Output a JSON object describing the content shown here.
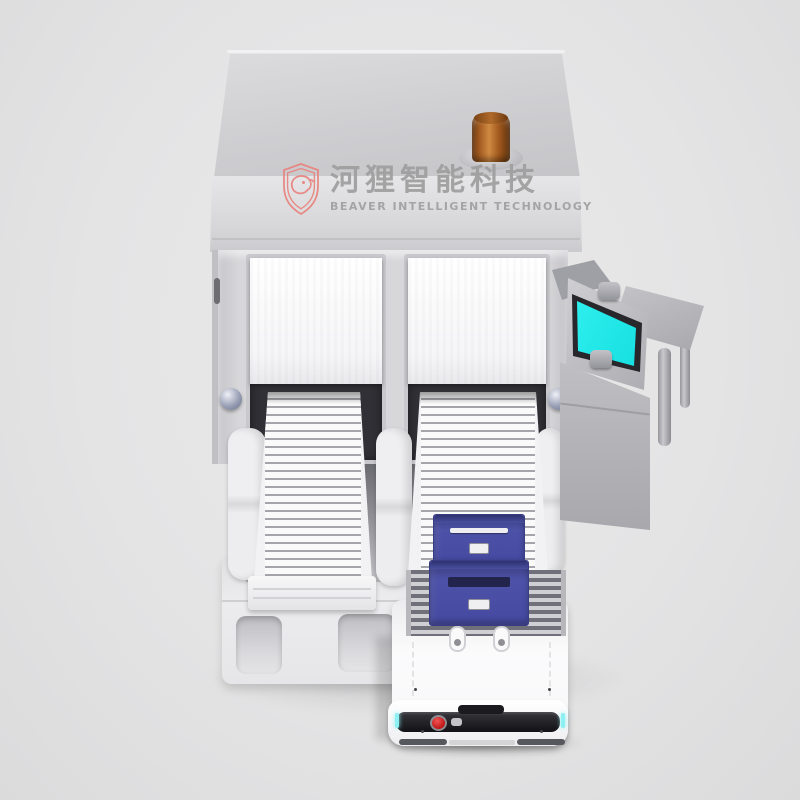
{
  "meta": {
    "kind": "product-render",
    "canvas": {
      "width": 800,
      "height": 800
    },
    "background_color": "#e4e4e4"
  },
  "watermark": {
    "brand_cn": "河狸智能科技",
    "brand_en": "BEAVER INTELLIGENT TECHNOLOGY",
    "icon": "beaver-shield-icon",
    "accent_color": "#e8837e",
    "text_color": "#9e9e9e"
  },
  "scene": {
    "description": "3D render of an automated tote-handling workstation: gray cabinet with amber beacon, two white roller-shutter ports feeding sloped roller conveyors, side touchscreen console with table, two blue totes on the right conveyor, and a white AGV robot docked at a floor platform",
    "cabinet": {
      "name": "sorting-cabinet",
      "body_color": "#d5d5d8",
      "beacon": {
        "name": "amber-beacon-light",
        "color": "#a85f23"
      },
      "shutters": [
        {
          "name": "left-shutter-door",
          "color": "#fbfbfb"
        },
        {
          "name": "right-shutter-door",
          "color": "#fbfbfb"
        }
      ],
      "conveyors": [
        {
          "name": "left-roller-ramp",
          "roller_color": "#fafafa"
        },
        {
          "name": "right-roller-ramp",
          "roller_color": "#fafafa"
        }
      ],
      "dome_buttons": 2
    },
    "console": {
      "name": "side-control-console",
      "screen_color": "#1de9e9"
    },
    "table": {
      "name": "side-table",
      "color": "#b5b5ba"
    },
    "totes": [
      {
        "name": "upper-blue-tote",
        "color": "#4d52a8"
      },
      {
        "name": "lower-blue-tote",
        "color": "#4d52a8"
      }
    ],
    "agv": {
      "name": "agv-robot",
      "body_color": "#fafafa",
      "deck": "dark-roller-deck",
      "estop_color": "#bd1515",
      "accent_light_color": "#8df0f3"
    },
    "dock": {
      "name": "floor-dock-platform",
      "color": "#e9e9eb",
      "notches": 2
    }
  }
}
